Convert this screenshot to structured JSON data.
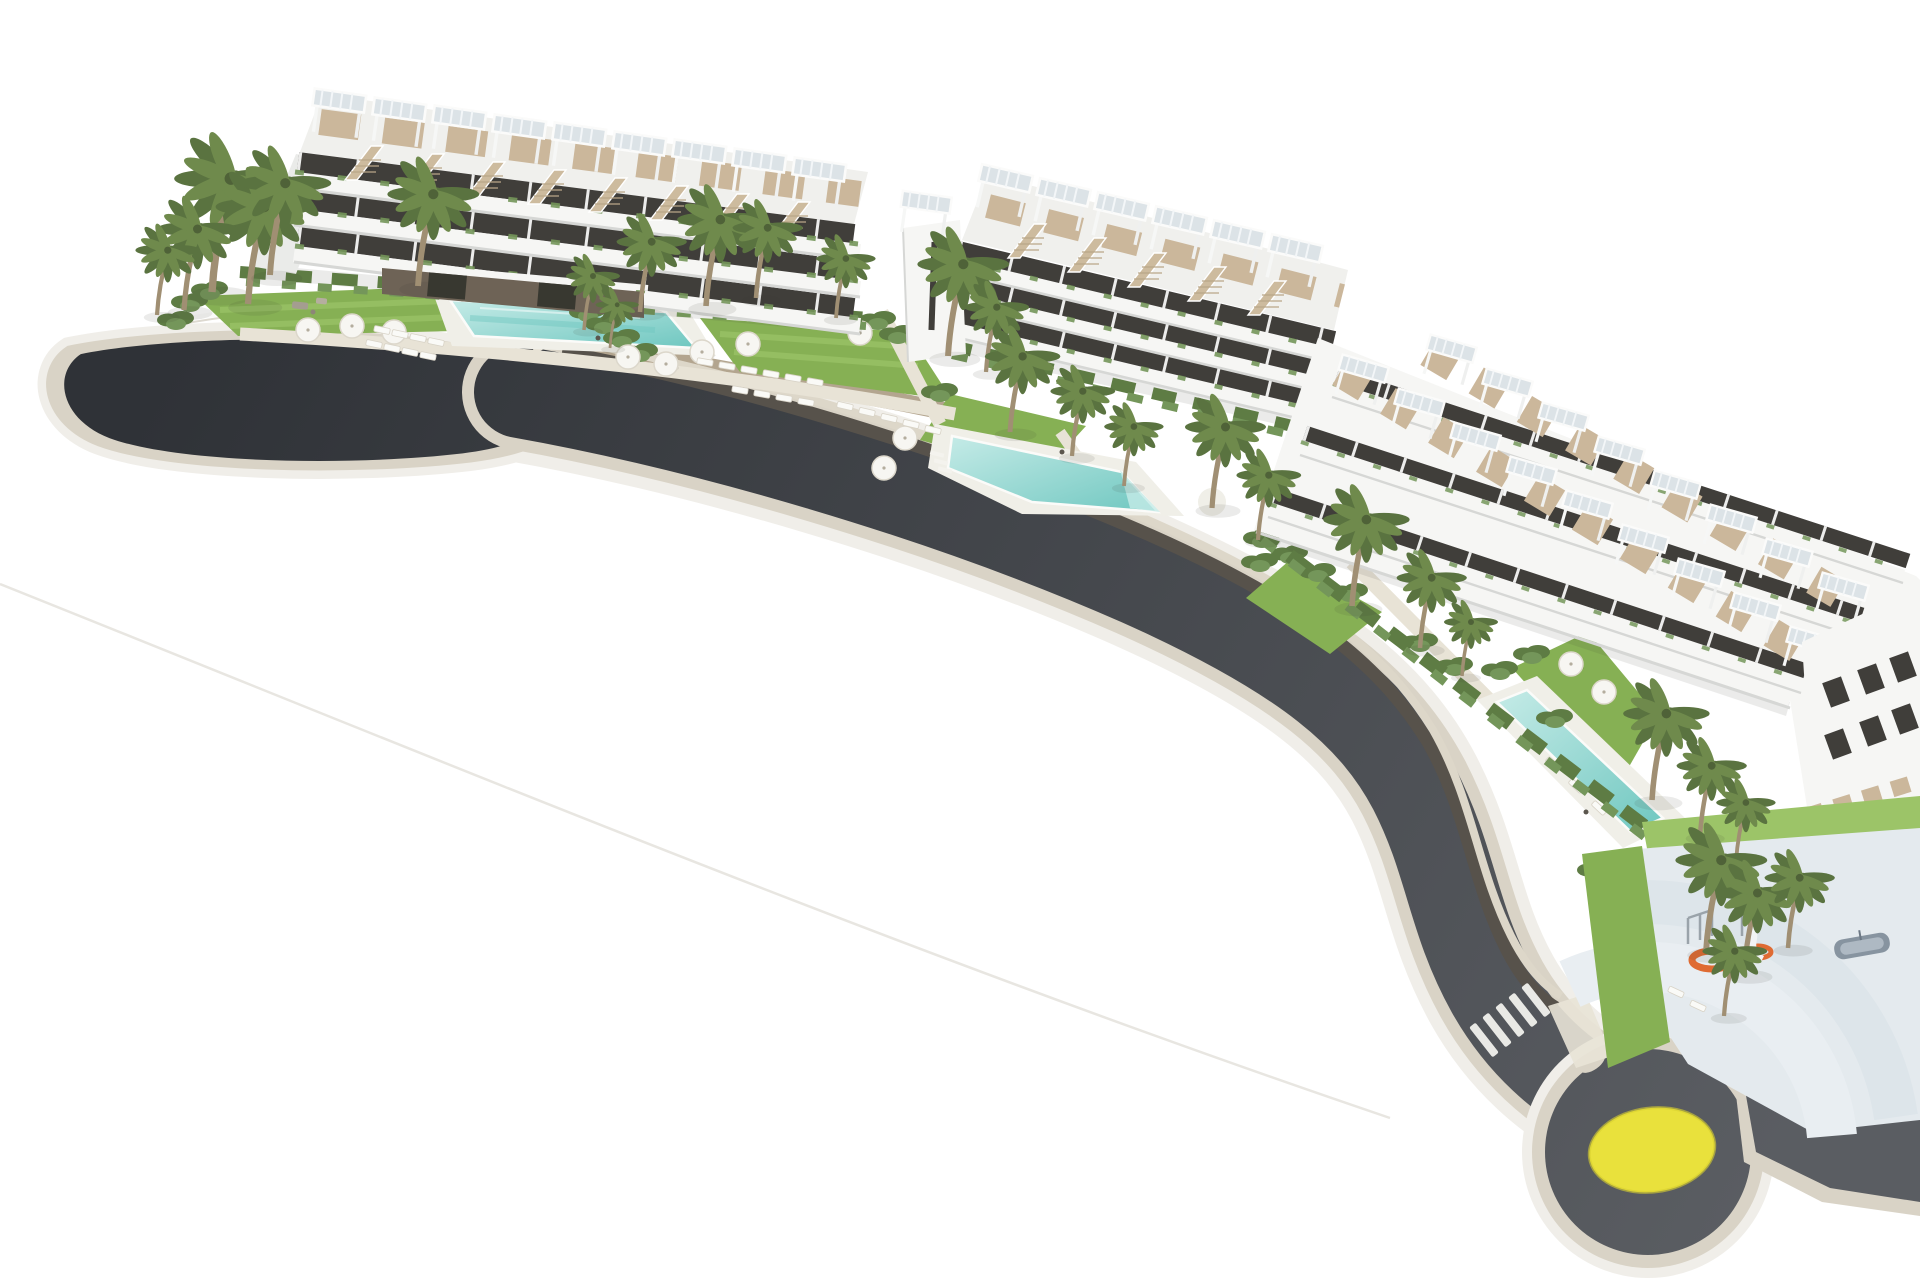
{
  "scene": {
    "title": "Aerial 3D architectural rendering of a white terraced seaside apartment complex with rooftop pergola terraces, landscaped gardens, swimming pools, palm trees, a curved access road ending in a cul-de-sac, and a roundabout with a yellow centre island"
  },
  "colors": {
    "bg": "#ffffff",
    "asphalt_dark": "#2f3237",
    "asphalt_light": "#5a5d62",
    "curb": "#d9d3c6",
    "apron": "#f0eee9",
    "seam": "#e8e6e1",
    "road_wall": "#57524b",
    "sidewalk": "#ddd7c9",
    "stone_wall": "#b3a58f",
    "building_white": "#f6f6f4",
    "building_face": "#eaebe9",
    "building_shade": "#d6d7d5",
    "roof_white": "#f0f0ed",
    "window_dark": "#403e3a",
    "deck_tan": "#cbb79b",
    "stair_tan": "#cdbb9e",
    "pergola_slat": "#dce3e7",
    "stone_dark": "#6e6356",
    "door_dark": "#383830",
    "lawn": "#86b054",
    "lawn_light": "#9cc468",
    "shrub": "#5e7c44",
    "shrub_light": "#74965a",
    "palm_frond": "#6f8a4c",
    "palm_frond_dark": "#5a7340",
    "palm_trunk": "#a08f73",
    "pool_light": "#c5ebe7",
    "pool_deep": "#6fc7c0",
    "pool_deck": "#f0efe8",
    "path": "#e8e3d6",
    "umbrella": "#f7f6f2",
    "umbrella_edge": "#dcd7cb",
    "roundabout_yellow": "#e9e13c",
    "marking_white": "#e9e9e5",
    "plaza_floor": "#e4eaee",
    "plaza_wall": "#e9eef2",
    "plaza_wall2": "#dde5ea",
    "playground_orange": "#df6b33",
    "equipment_gray": "#9aa3aa",
    "boat_gray": "#8794a0",
    "shadow": "rgba(60,60,50,0.10)"
  },
  "features": {
    "building_blocks": 3,
    "swimming_pools": 3,
    "rooftop_pergolas_block_1": 9,
    "rooftop_pergolas_block_2": 7,
    "rooftop_pergolas_block_3": 17,
    "roundabout_count": 1,
    "roundabout_center_color": "#e9e13c",
    "cul_de_sac_count": 1,
    "playground_count": 1,
    "crosswalk_count": 1,
    "parasols": 12,
    "sun_loungers": 29,
    "palm_trees_approx": 29
  }
}
